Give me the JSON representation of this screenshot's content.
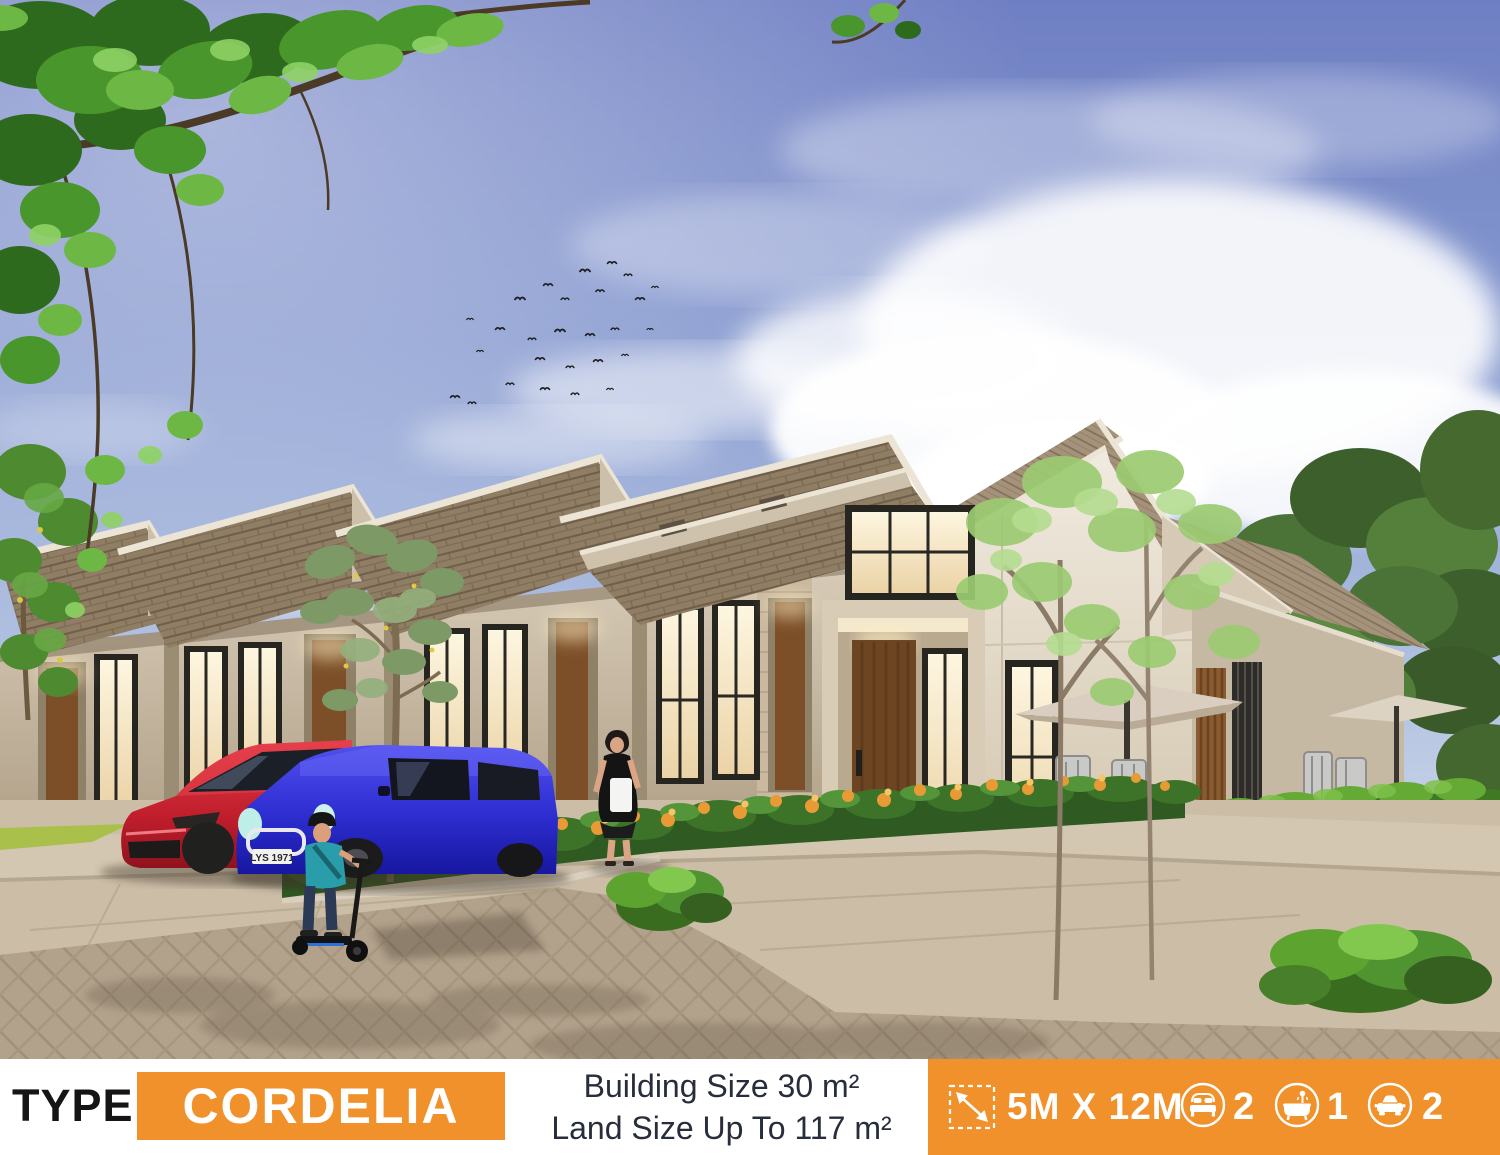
{
  "banner": {
    "type_label": "TYPE",
    "type_value": "CORDELIA",
    "building_size": "Building Size 30 m²",
    "land_size": "Land Size Up To 117 m²",
    "dimensions": "5M X 12M",
    "bedrooms": "2",
    "bathrooms": "1",
    "carports": "2",
    "accent_color": "#F0912B",
    "icons": [
      "dimension-icon",
      "bed-icon",
      "bath-icon",
      "car-icon"
    ]
  },
  "scene": {
    "description": "3D architectural rendering of a row of modern single-storey terrace houses with brown shingle gable roofs, warm lit windows, wooden doors, front garden with orange flowers, hedge, slender trees, a red car and a blue mini car parked in the driveway, a woman walking with a shopping bag, a boy riding a kick scooter on a herringbone paved street, blue sky with clouds, a flock of birds and an overhanging leafy branch",
    "license_plate": "LYS 1971"
  }
}
